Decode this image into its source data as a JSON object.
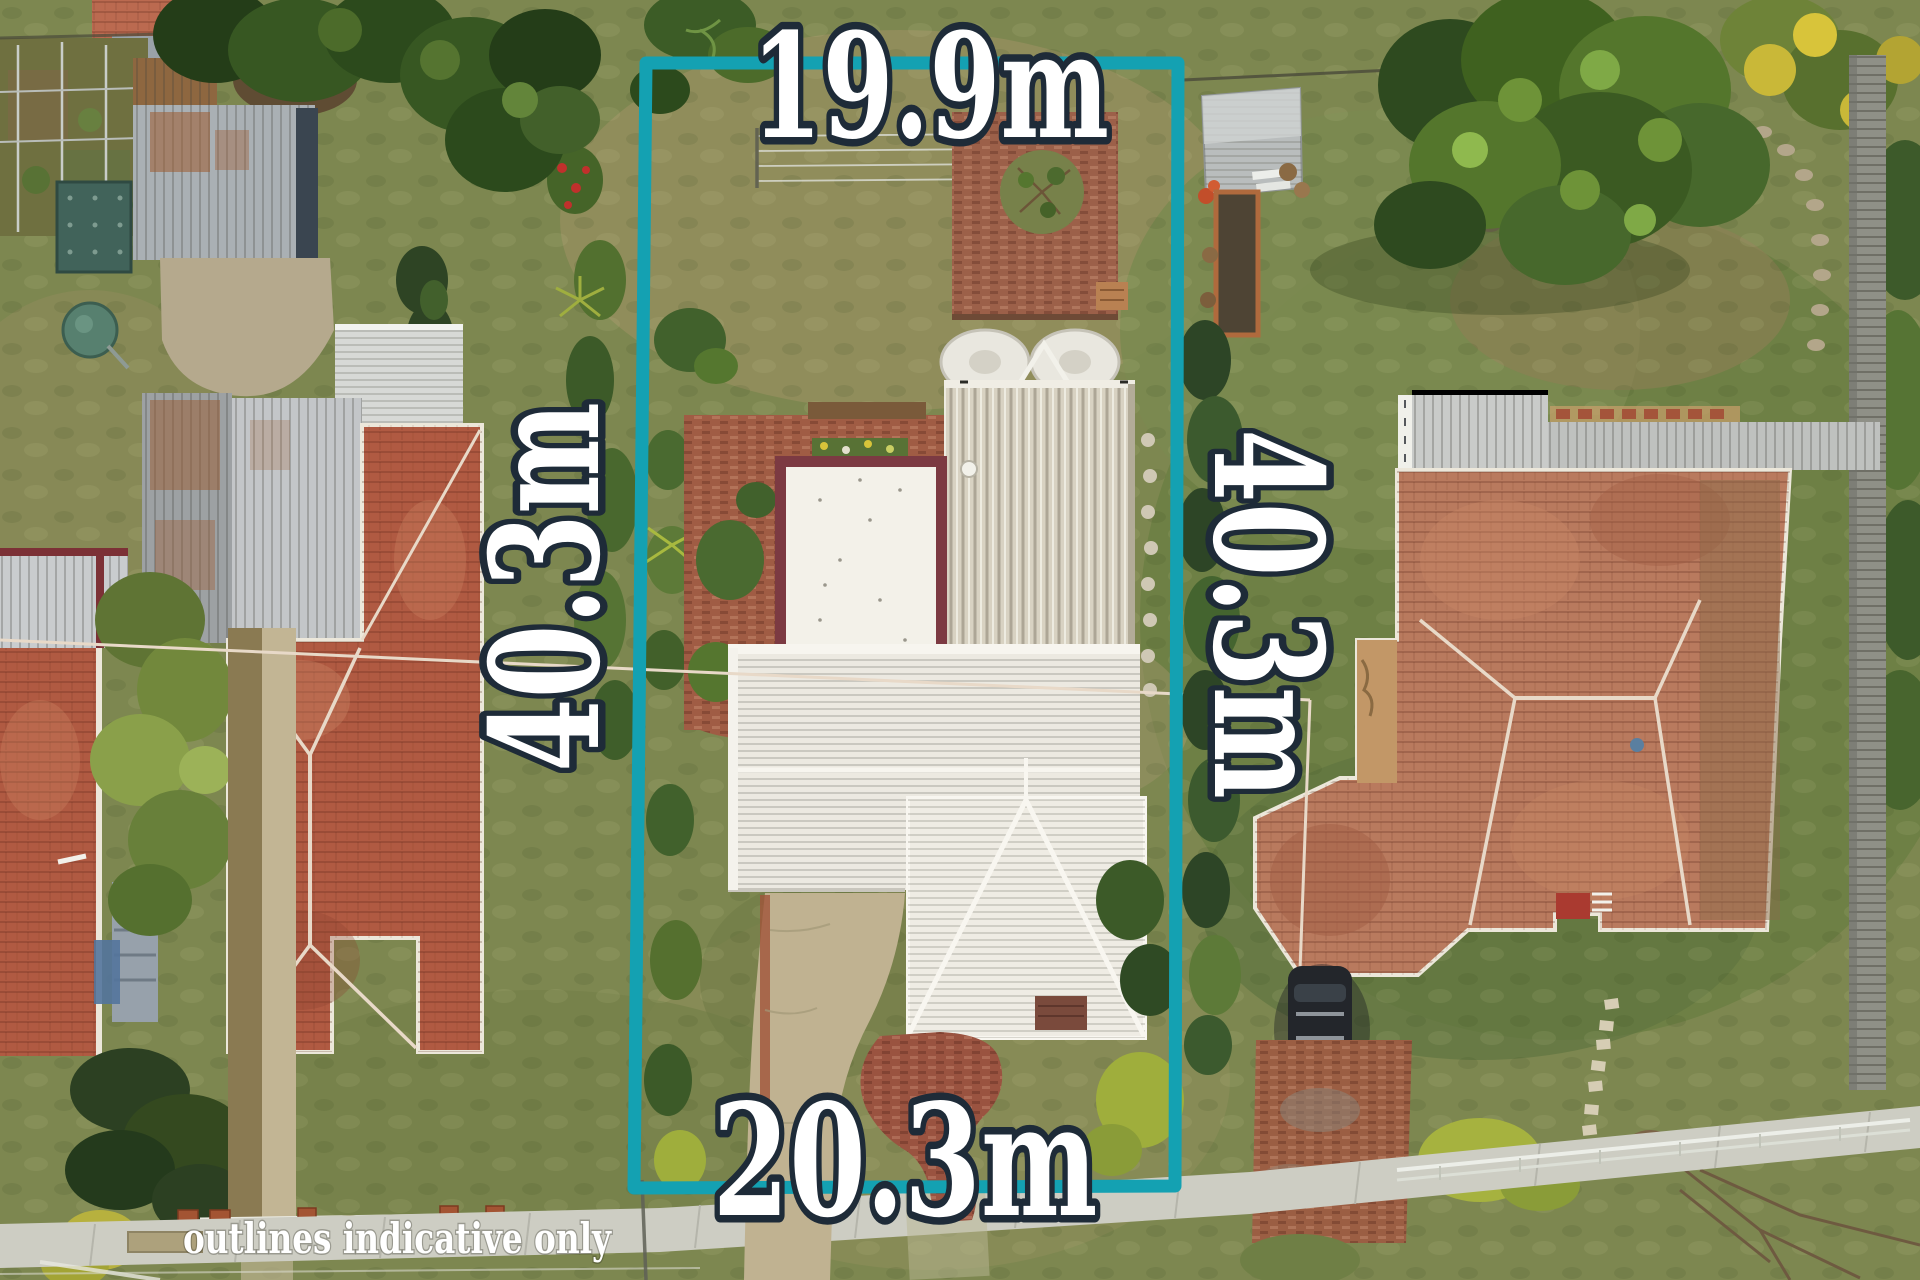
{
  "annotation": {
    "top_dimension": "19.9m",
    "left_dimension": "40.3m",
    "right_dimension": "40.3m",
    "bottom_dimension": "20.3m",
    "disclaimer": "outlines indicative only",
    "colors": {
      "boundary_teal": "#14a1b2",
      "label_fill": "#ffffff",
      "label_outline": "#1e2b38"
    }
  },
  "scene_palette": {
    "grass_base": "#7d8750",
    "grass_olive": "#938e5d",
    "grass_green": "#6d8044",
    "terracotta_roof": "#b05a42",
    "terracotta_roof_light": "#c07f60",
    "white_metal_roof": "#ece9e1",
    "cream_ribbed_roof": "#d8d2c2",
    "flat_roof_frame_maroon": "#7c3a42",
    "brick_paving": "#9b5e43",
    "concrete": "#cdcdc3",
    "shed_gray": "#aab0b4",
    "garden_shed_teal": "#41635a",
    "water_tank_green": "#57806f",
    "car_black": "#23262b"
  }
}
